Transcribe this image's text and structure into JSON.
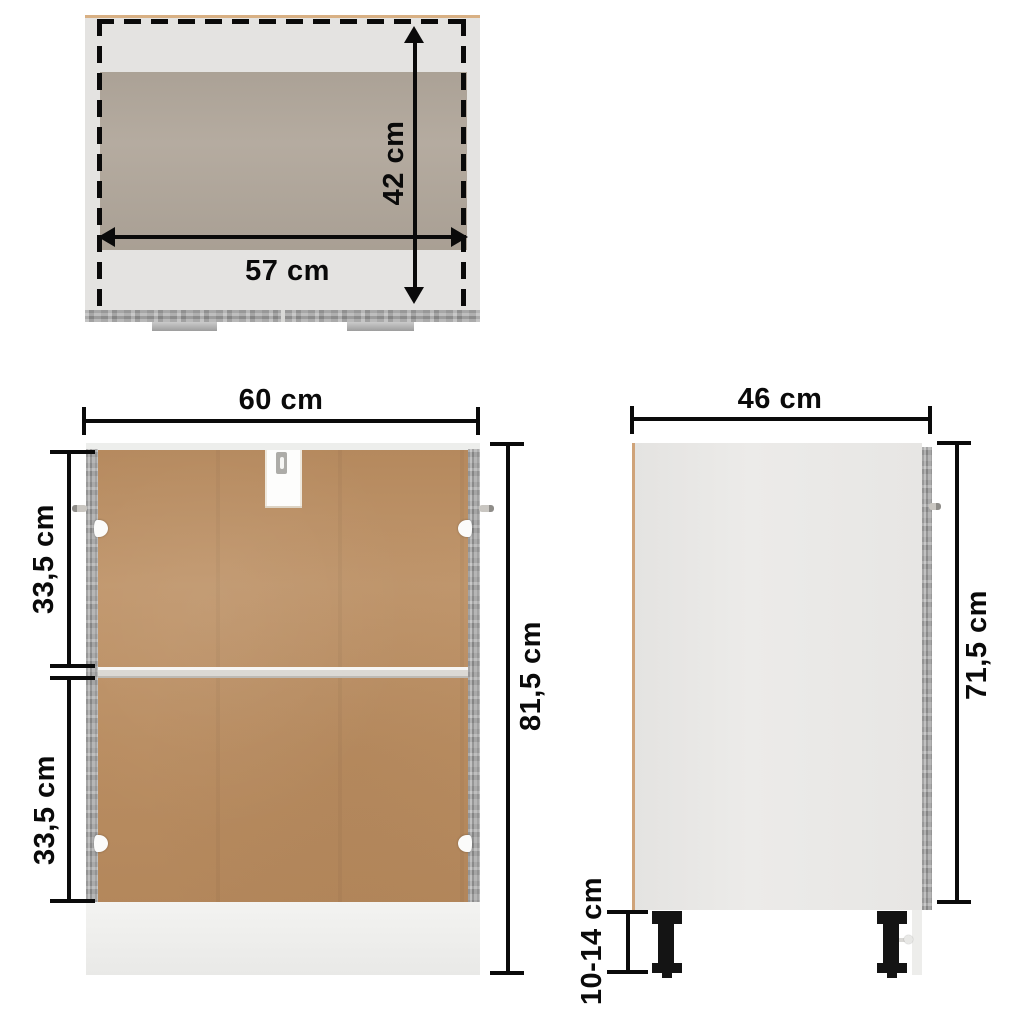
{
  "diagram": {
    "type": "furniture-dimension-diagram",
    "views": {
      "top": {
        "width": "57 cm",
        "depth": "42 cm"
      },
      "front": {
        "width": "60 cm",
        "upper_section": "33,5 cm",
        "lower_section": "33,5 cm",
        "total_height": "81,5 cm"
      },
      "side": {
        "depth": "46 cm",
        "body_height": "71,5 cm",
        "legs_height": "10-14 cm"
      }
    },
    "colors": {
      "back_panel_hardboard": "#bd9165",
      "frame_concrete_gray": "#a3a3a3",
      "interior_taupe": "#b2a89c",
      "edge_tan": "#cfa379",
      "panel_light_gray": "#e4e3e1",
      "dimension_lines": "#0a0a0a",
      "legs_black": "#141414",
      "background": "#ffffff"
    }
  }
}
